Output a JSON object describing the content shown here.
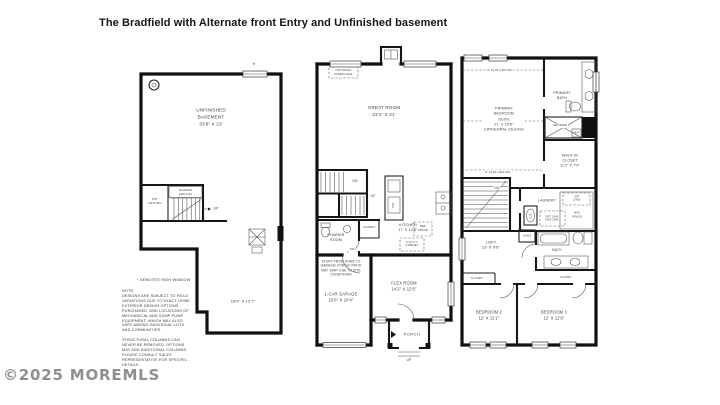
{
  "title": "The Bradfield with Alternate front Entry and Unfinished basement",
  "watermark": "©2025 MOREMLS",
  "basement": {
    "room": "UNFINISHED\nBASEMENT\n33'9\" X 23'",
    "sloped_ceiling": "SLOPED\nCEILING",
    "ceiling_height": "8'8\"\nCEILING",
    "up_label": "UP",
    "lower_room_dim": "18'6\" X 12'7\"",
    "high_window_asterisk": "*",
    "high_window_note": "* DENOTES HIGH WINDOW",
    "field_note": "NOTE:\nDESIGNS ARE SUBJECT TO FIELD\nVARIATIONS DUE TO EXACT HOME\nEXTERIOR DESIGN OPTIONS\nPURCHASED, AND LOCATIONS OF\nMECHANICAL AND SUMP PUMP\nEQUIPMENT, WHICH MAY ALSO\nVARY AMONG INDIVIDUAL LOTS\nAND COMMUNITIES.\n\nSTRUCTURAL COLUMNS CAN\nNEVER BE REMOVED. OPTIONS\nMAY ADD ADDITIONAL COLUMNS.\nPLEASE CONSULT SALES\nREPRESENTATIVE FOR SPECIFIC\nDETAILS."
  },
  "first_floor": {
    "optional_fireplace": "OPTIONAL\nFIREPLACE",
    "great_room": "GREAT ROOM\n23'1\" X 21'",
    "stairs_dn": "DN",
    "stairs_up": "UP",
    "powder_room": "POWDER\nROOM",
    "closet": "CLOSET",
    "kitchen": "KITCHEN\n17' X 12'6\"",
    "dishwasher": "DW",
    "ref_space": "REF\nSPACE",
    "utility_cabinet": "UTILITY\nCABINET",
    "door_dn": "DN",
    "steps_note": "STEPS FROM HOME TO\nGARAGE/ PORCH/ PATIO\nMAY VARY DUE TO SITE\nCONDITIONS",
    "garage": "1-CAR GARAGE\n23'6\" X 10'4\"",
    "flex_room": "FLEX ROOM\n14'2\" X 12'6\"",
    "porch": "PORCH",
    "porch_up": "UP"
  },
  "second_floor": {
    "flat_ceiling_top": "8' FLAT CEILING",
    "flat_ceiling_mid": "8' FLAT CEILING",
    "primary_suite": "PRIMARY\nBEDROOM\nSUITE\n21' X 15'6\"\nCATHEDRAL CEILING",
    "primary_bath": "PRIMARY\nBATH",
    "shower": "SHOWER",
    "seat": "SEAT",
    "walk_in_closet": "WALK-IN\nCLOSET\n11'2\" X 7'4\"",
    "stairs_dn": "DN",
    "laundry": "LAUNDRY",
    "opt_cabs": "OPT\nCABS",
    "wd_space": "W/D\nSPACE",
    "tub": "TUB",
    "opt_sink": "OPT SINK\nAND CABS",
    "linen": "LINEN",
    "loft": "LOFT\n13' X 9'6\"",
    "bath": "BATH",
    "closet_left": "CLOSET",
    "closet_right": "CLOSET",
    "bedroom_2": "BEDROOM 2\n12' X 11'1\"",
    "bedroom_3": "BEDROOM 3\n12' X 11'9\""
  }
}
